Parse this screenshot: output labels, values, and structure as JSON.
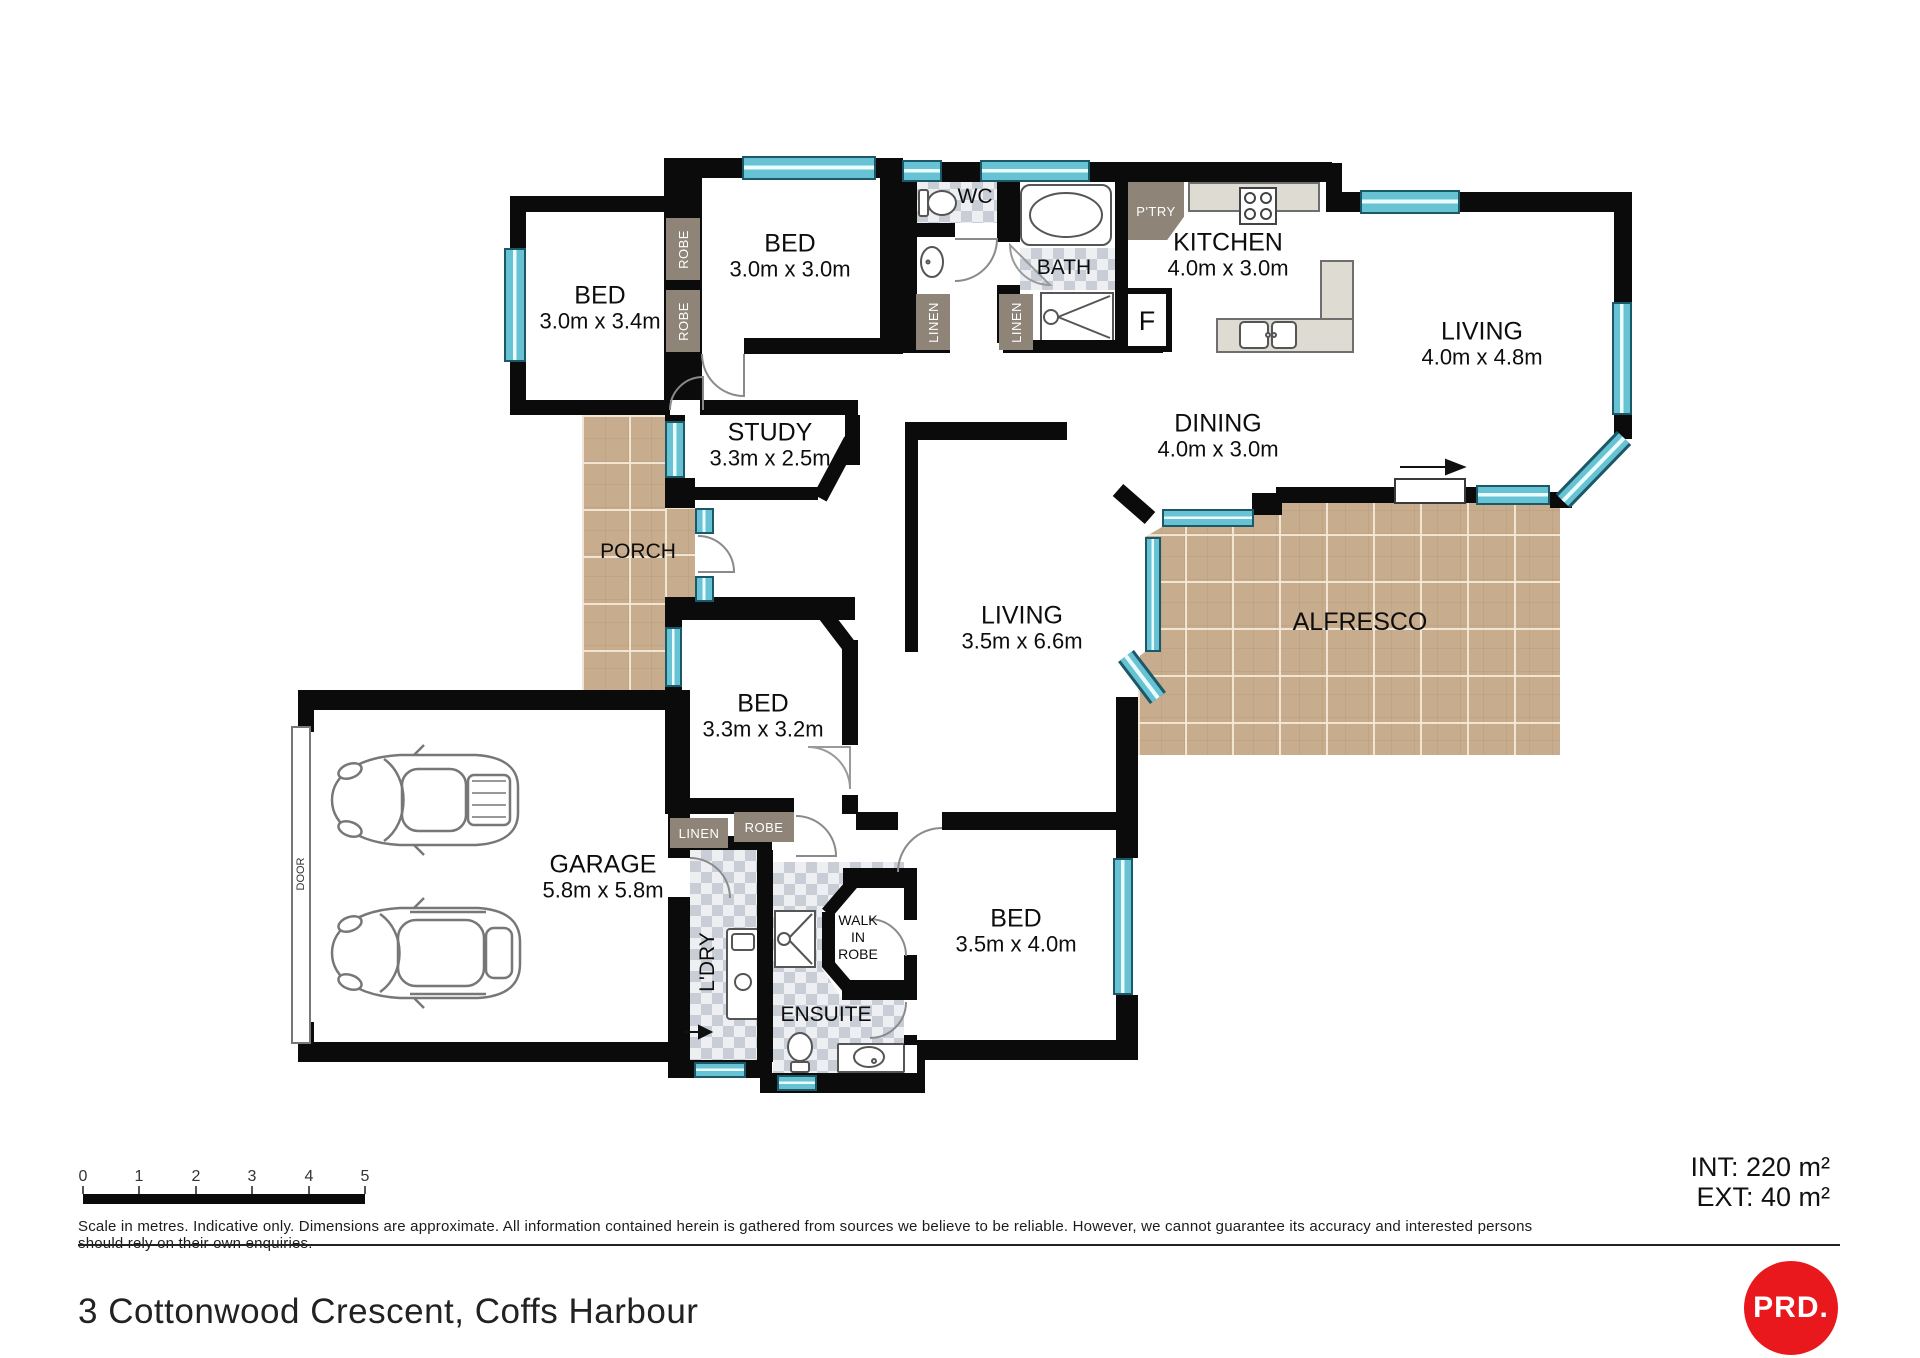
{
  "plan": {
    "rooms": {
      "bed1": {
        "name": "BED",
        "dims": "3.0m x 3.4m"
      },
      "bed2": {
        "name": "BED",
        "dims": "3.0m x 3.0m"
      },
      "bed3": {
        "name": "BED",
        "dims": "3.3m x 3.2m"
      },
      "bed4": {
        "name": "BED",
        "dims": "3.5m x 4.0m"
      },
      "study": {
        "name": "STUDY",
        "dims": "3.3m x 2.5m"
      },
      "kitchen": {
        "name": "KITCHEN",
        "dims": "4.0m x 3.0m"
      },
      "living1": {
        "name": "LIVING",
        "dims": "4.0m x 4.8m"
      },
      "living2": {
        "name": "LIVING",
        "dims": "3.5m x 6.6m"
      },
      "dining": {
        "name": "DINING",
        "dims": "4.0m x 3.0m"
      },
      "garage": {
        "name": "GARAGE",
        "dims": "5.8m x 5.8m"
      },
      "wc": {
        "name": "WC"
      },
      "bath": {
        "name": "BATH"
      },
      "pantry": {
        "name": "P'TRY"
      },
      "fridge": {
        "name": "F"
      },
      "porch": {
        "name": "PORCH"
      },
      "alfresco": {
        "name": "ALFRESCO"
      },
      "ensuite": {
        "name": "ENSUITE"
      },
      "laundry": {
        "name": "L'DRY"
      },
      "walk_in_robe": {
        "line1": "WALK",
        "line2": "IN",
        "line3": "ROBE"
      },
      "garage_door": {
        "name": "DOOR"
      },
      "robe": "ROBE",
      "linen": "LINEN"
    }
  },
  "footer": {
    "scale_numbers": [
      "0",
      "1",
      "2",
      "3",
      "4",
      "5"
    ],
    "disclaimer": "Scale in metres. Indicative only. Dimensions are approximate. All information contained herein is gathered from sources we believe to be reliable. However, we cannot guarantee its accuracy and interested persons should rely on their own enquiries.",
    "area_int": "INT: 220 m²",
    "area_ext": "EXT: 40 m²",
    "address": "3 Cottonwood Crescent, Coffs Harbour",
    "logo": "PRD."
  },
  "colors": {
    "wall": "#0b0b0b",
    "window": "#67c2d4",
    "paving": "#c7ac8e",
    "closet": "#8e8478",
    "logo_red": "#e8181d"
  }
}
